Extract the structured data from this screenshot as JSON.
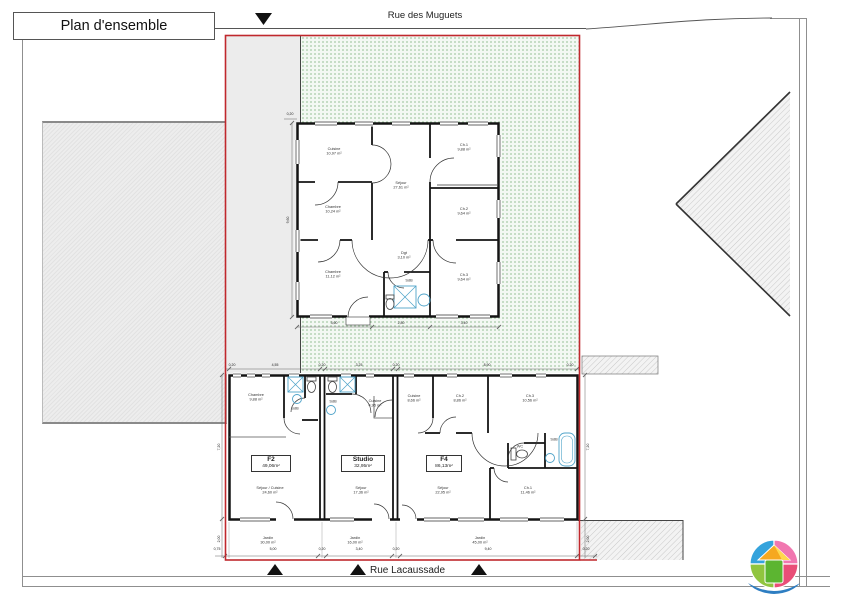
{
  "title": "Plan d'ensemble",
  "streets": {
    "top": "Rue des Muguets",
    "bottom": "Rue Lacaussade"
  },
  "colors": {
    "boundary": "#c0282d",
    "garden_dot": "#5a9b5a",
    "fixture": "#4fa3c9",
    "wall": "#141414"
  },
  "house": {
    "rooms": [
      {
        "name": "Cuisine",
        "area": "10,97 m²"
      },
      {
        "name": "Séjour",
        "area": "27,61 m²"
      },
      {
        "name": "Ch.1",
        "area": "9,88 m²"
      },
      {
        "name": "Ch.2",
        "area": "9,64 m²"
      },
      {
        "name": "Chambre",
        "area": "10,24 m²"
      },
      {
        "name": "Chambre",
        "area": "11,12 m²"
      },
      {
        "name": "Dgt",
        "area": "3,10 m²"
      },
      {
        "name": "SdB",
        "area": "4,05 m²"
      },
      {
        "name": "Ch.3",
        "area": "9,64 m²"
      }
    ]
  },
  "units": [
    {
      "name": "F2",
      "surface": "49,06m²",
      "rooms": [
        {
          "name": "Chambre",
          "area": "9,88 m²"
        },
        {
          "name": "SdB",
          "area": "3,75 m²"
        },
        {
          "name": "Séjour / Cuisine",
          "area": "24,60 m²"
        }
      ]
    },
    {
      "name": "Studio",
      "surface": "32,95m²",
      "rooms": [
        {
          "name": "SdB",
          "area": "3,60 m²"
        },
        {
          "name": "Cuisine",
          "area": "4,95 m²"
        },
        {
          "name": "Séjour",
          "area": "17,36 m²"
        }
      ]
    },
    {
      "name": "F4",
      "surface": "86,13m²",
      "rooms": [
        {
          "name": "Cuisine",
          "area": "8,66 m²"
        },
        {
          "name": "Ch.2",
          "area": "8,86 m²"
        },
        {
          "name": "Ch.3",
          "area": "10,56 m²"
        },
        {
          "name": "Séjour",
          "area": "22,95 m²"
        },
        {
          "name": "Ch.1",
          "area": "11,46 m²"
        },
        {
          "name": "WC",
          "area": ""
        },
        {
          "name": "SdB",
          "area": ""
        }
      ]
    }
  ],
  "gardens": [
    {
      "name": "Jardin",
      "area": "30,00 m²"
    },
    {
      "name": "Jardin",
      "area": "16,00 m²"
    },
    {
      "name": "Jardin",
      "area": "45,00 m²"
    }
  ],
  "dims": {
    "bottom": [
      "0,75",
      "5,00",
      "0,20",
      "3,40",
      "0,20",
      "9,40",
      "0,20"
    ],
    "top_building": [
      "0,20",
      "4,55",
      "0,20",
      "3,25",
      "0,20",
      "8,90",
      "0,20"
    ],
    "house_bottom": [
      "3,60",
      "2,80",
      "3,40"
    ],
    "house_left": "9,60",
    "house_top_offset": "0,20",
    "building_left": "7,20",
    "building_right": "7,20",
    "garden_strip": "2,00"
  }
}
